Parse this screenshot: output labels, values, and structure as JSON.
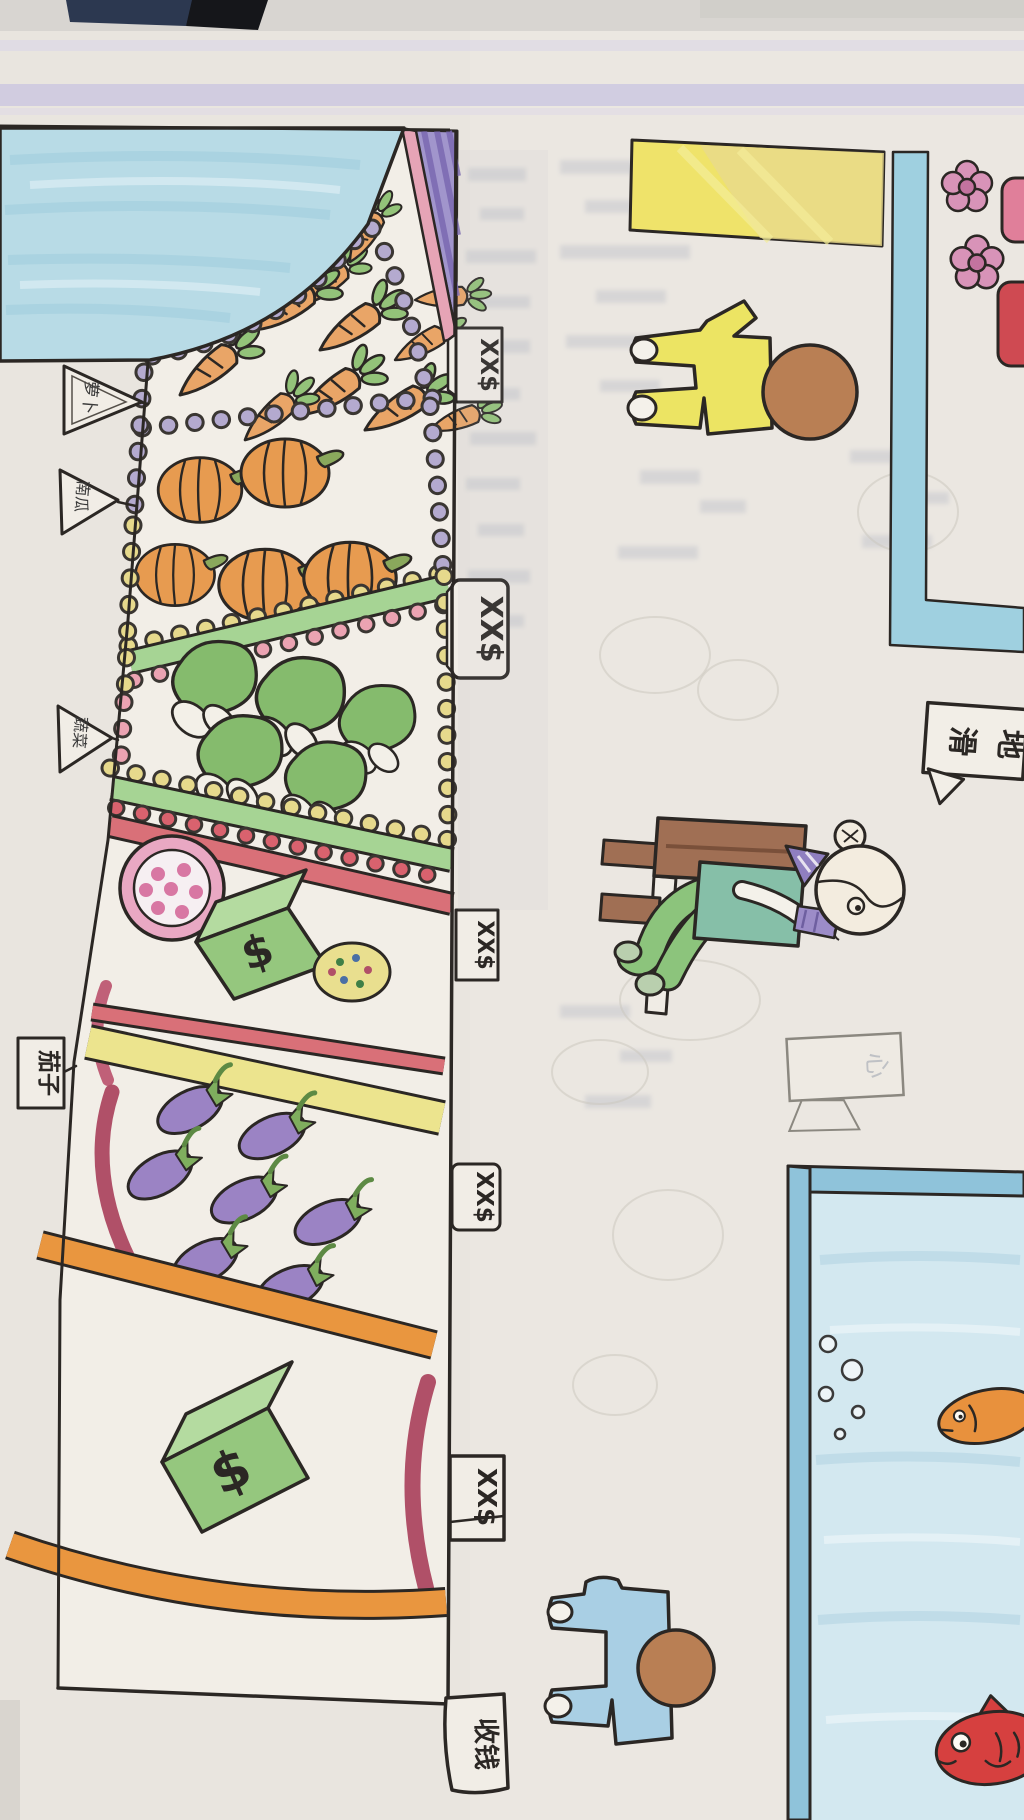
{
  "stall": {
    "price_tags": [
      "XX$",
      "XX$",
      "XX$",
      "XX$",
      "XX$"
    ],
    "cashier_tag": "收钱",
    "pennants": [
      "萝卜",
      "南瓜",
      "蔬菜"
    ],
    "eggplant_tag": "茄子",
    "money_symbol": "$"
  },
  "signs": {
    "floor_warning_char_1": "地",
    "floor_warning_char_2": "滑",
    "faint_sign": "心"
  },
  "colors": {
    "canopy_blue": "#b8dbe6",
    "roof_purple": "#a195cc",
    "carrot_orange": "#e9a567",
    "pumpkin_orange": "#e79b50",
    "cabbage_green": "#85bb6d",
    "eggplant_purple": "#9b83c4",
    "money_box_green": "#95c77e",
    "tank_blue": "#8fc3da",
    "fish_red": "#d6403f",
    "fish_orange": "#e8913d",
    "banner_yellow": "#efe36a",
    "stripe_lavender": "#ccc8e0"
  }
}
